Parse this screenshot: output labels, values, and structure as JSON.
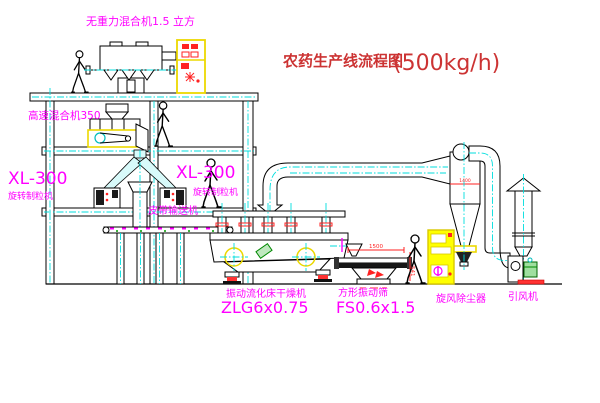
{
  "title": {
    "text": "农药生产线流程图",
    "capacity": "(500kg/h)"
  },
  "equipment_labels": {
    "gravity_mixer": "无重力混合机1.5 立方",
    "high_speed_mixer": "高速混合机350",
    "granulator_left_model": "XL-300",
    "granulator_left_name": "旋转制粒机",
    "granulator_mid_model": "XL-300",
    "granulator_mid_name": "旋转制粒机",
    "belt_conveyor": "皮带输送机",
    "fluid_bed_dryer_name": "振动流化床干燥机",
    "fluid_bed_dryer_model": "ZLG6x0.75",
    "square_sieve_name": "方形振动筛",
    "square_sieve_model": "FS0.6x1.5",
    "cyclone_dust_collector": "旋风除尘器",
    "induced_draft_fan": "引风机"
  },
  "dimensions": {
    "sieve_length": "1500",
    "sieve_height": "541",
    "cyclone_diameter": "1400"
  },
  "colors": {
    "label_magenta": "#ff00ff",
    "title_red": "#cc3333",
    "dimension_red": "#ff2222",
    "centerline_cyan": "#00dede",
    "highlight_yellow": "#ecd800",
    "line_black": "#000000"
  }
}
